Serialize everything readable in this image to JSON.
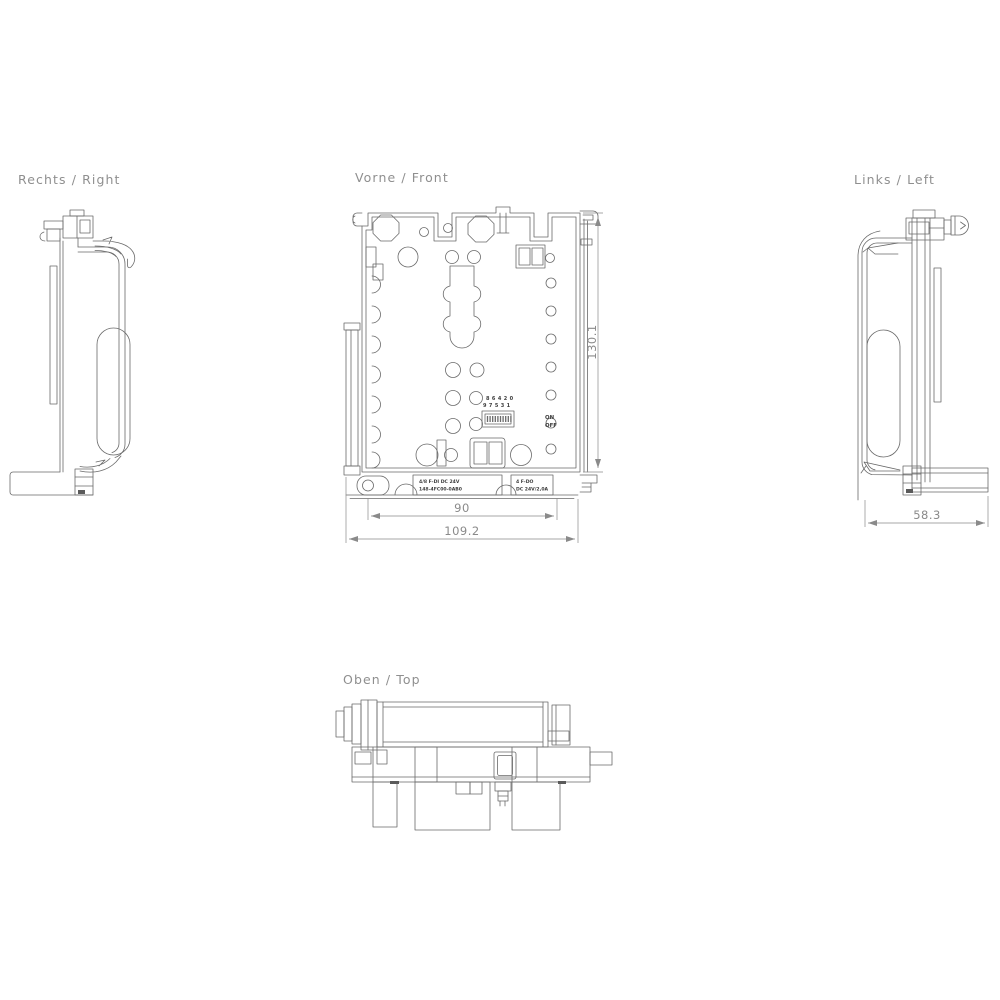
{
  "drawing": {
    "views": {
      "right": {
        "label": "Rechts / Right"
      },
      "front": {
        "label": "Vorne / Front"
      },
      "left": {
        "label": "Links / Left"
      },
      "top": {
        "label": "Oben / Top"
      }
    },
    "front": {
      "dip_switch": {
        "numbers_top": "8 6 4 2 0",
        "numbers_bottom": "9 7 5 3 1",
        "on_label": "ON",
        "off_label": "OFF"
      },
      "module_labels": {
        "left_module": {
          "line1": "4/8 F-DI DC 24V",
          "line2": "148-4FC00-0AB0"
        },
        "right_module": {
          "line1": "4 F-DO",
          "line2": "DC 24V/2,0A"
        }
      }
    },
    "dimensions": {
      "height": "130.1",
      "inner_width": "90",
      "outer_width": "109.2",
      "depth": "58.3"
    },
    "colors": {
      "background": "#ffffff",
      "line": "#6a6a6a",
      "dimension": "#8a8a8a",
      "label": "#8f8f8f",
      "small_text": "#3c3c3c"
    }
  }
}
